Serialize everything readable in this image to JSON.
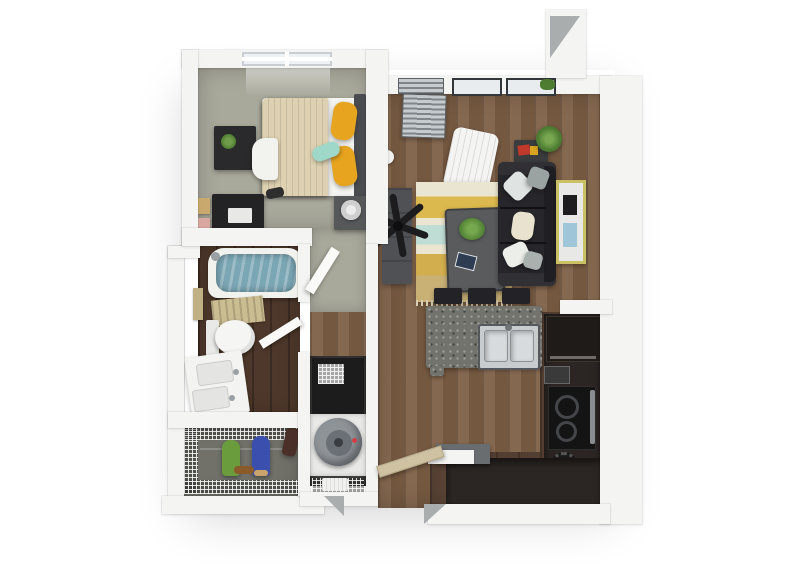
{
  "scene": {
    "type": "3d-apartment-floor-plan-render",
    "view": "top-down",
    "rooms": [
      "bedroom",
      "bathroom",
      "walk-in-closet",
      "laundry-closet",
      "hallway",
      "living-room",
      "kitchen",
      "entry"
    ],
    "bedroom_items": [
      "bed",
      "yellow-pillows",
      "teal-pillow",
      "cream-blanket",
      "headboard",
      "nightstand",
      "lamp",
      "dresser",
      "plant",
      "white-chair",
      "desk",
      "wall-frames",
      "window"
    ],
    "bathroom_items": [
      "bathtub",
      "water",
      "bath-mat",
      "toilet",
      "double-sink-vanity",
      "towel",
      "door"
    ],
    "closet_items": [
      "wire-shelving",
      "hanging-clothes-green",
      "hanging-clothes-blue",
      "garment-bag",
      "shoes"
    ],
    "laundry_items": [
      "stacked-washer-dryer",
      "wire-basket",
      "towel-shelf"
    ],
    "living_items": [
      "sofa",
      "throw-pillows",
      "striped-rug",
      "coffee-table",
      "plant",
      "tablet",
      "side-table",
      "books",
      "art-frame",
      "ceiling-fan",
      "media-console",
      "floor-lamp",
      "lounge-chair",
      "windows-with-blinds",
      "window-plants"
    ],
    "kitchen_items": [
      "island-with-granite-top",
      "double-stainless-sink",
      "bar-stools",
      "refrigerator",
      "cooktop",
      "oven",
      "toaster",
      "pot",
      "l-shaped-cabinets",
      "entry-counter"
    ],
    "entry_items": [
      "entry-door",
      "door-jambs"
    ]
  },
  "colors": {
    "background": "#ffffff",
    "wall": "#f4f4f2",
    "wall_cut_gray": "#a9adae",
    "bedroom_carpet": "#a8a89b",
    "closet_floor": "#71716a",
    "living_wood": "#7d5f45",
    "kitchen_dark_wood": "#5b4437",
    "bath_wood": "#4e382b",
    "bed_blanket": "#ddd1b1",
    "bed_sheet": "#f4f4f1",
    "pillow_yellow": "#e7a41e",
    "pillow_teal": "#9fd8c8",
    "headboard": "#4a4c50",
    "tub_water": "#7ba6b4",
    "bath_mat": "#cbbd92",
    "door_tan": "#cfc2a2",
    "sofa_dark": "#27272b",
    "rug_cream": "#eae5d1",
    "rug_yellow": "#dcb94e",
    "rug_teal": "#bfddd4",
    "rug_mustard": "#d2ae4e",
    "rug_tan": "#c9b176",
    "granite": "#72736c",
    "cabinet_dark": "#2b2523",
    "stainless": "#c9ccce",
    "plant_green": "#4e7d32",
    "accent_red": "#c0392b",
    "frame_yellow": "#c9c163",
    "washer_gray": "#8e9398",
    "closet_green": "#6a9c3e",
    "closet_blue": "#3a4fae",
    "furniture_gray": "#56585a",
    "fan_black": "#1c1c1e"
  }
}
